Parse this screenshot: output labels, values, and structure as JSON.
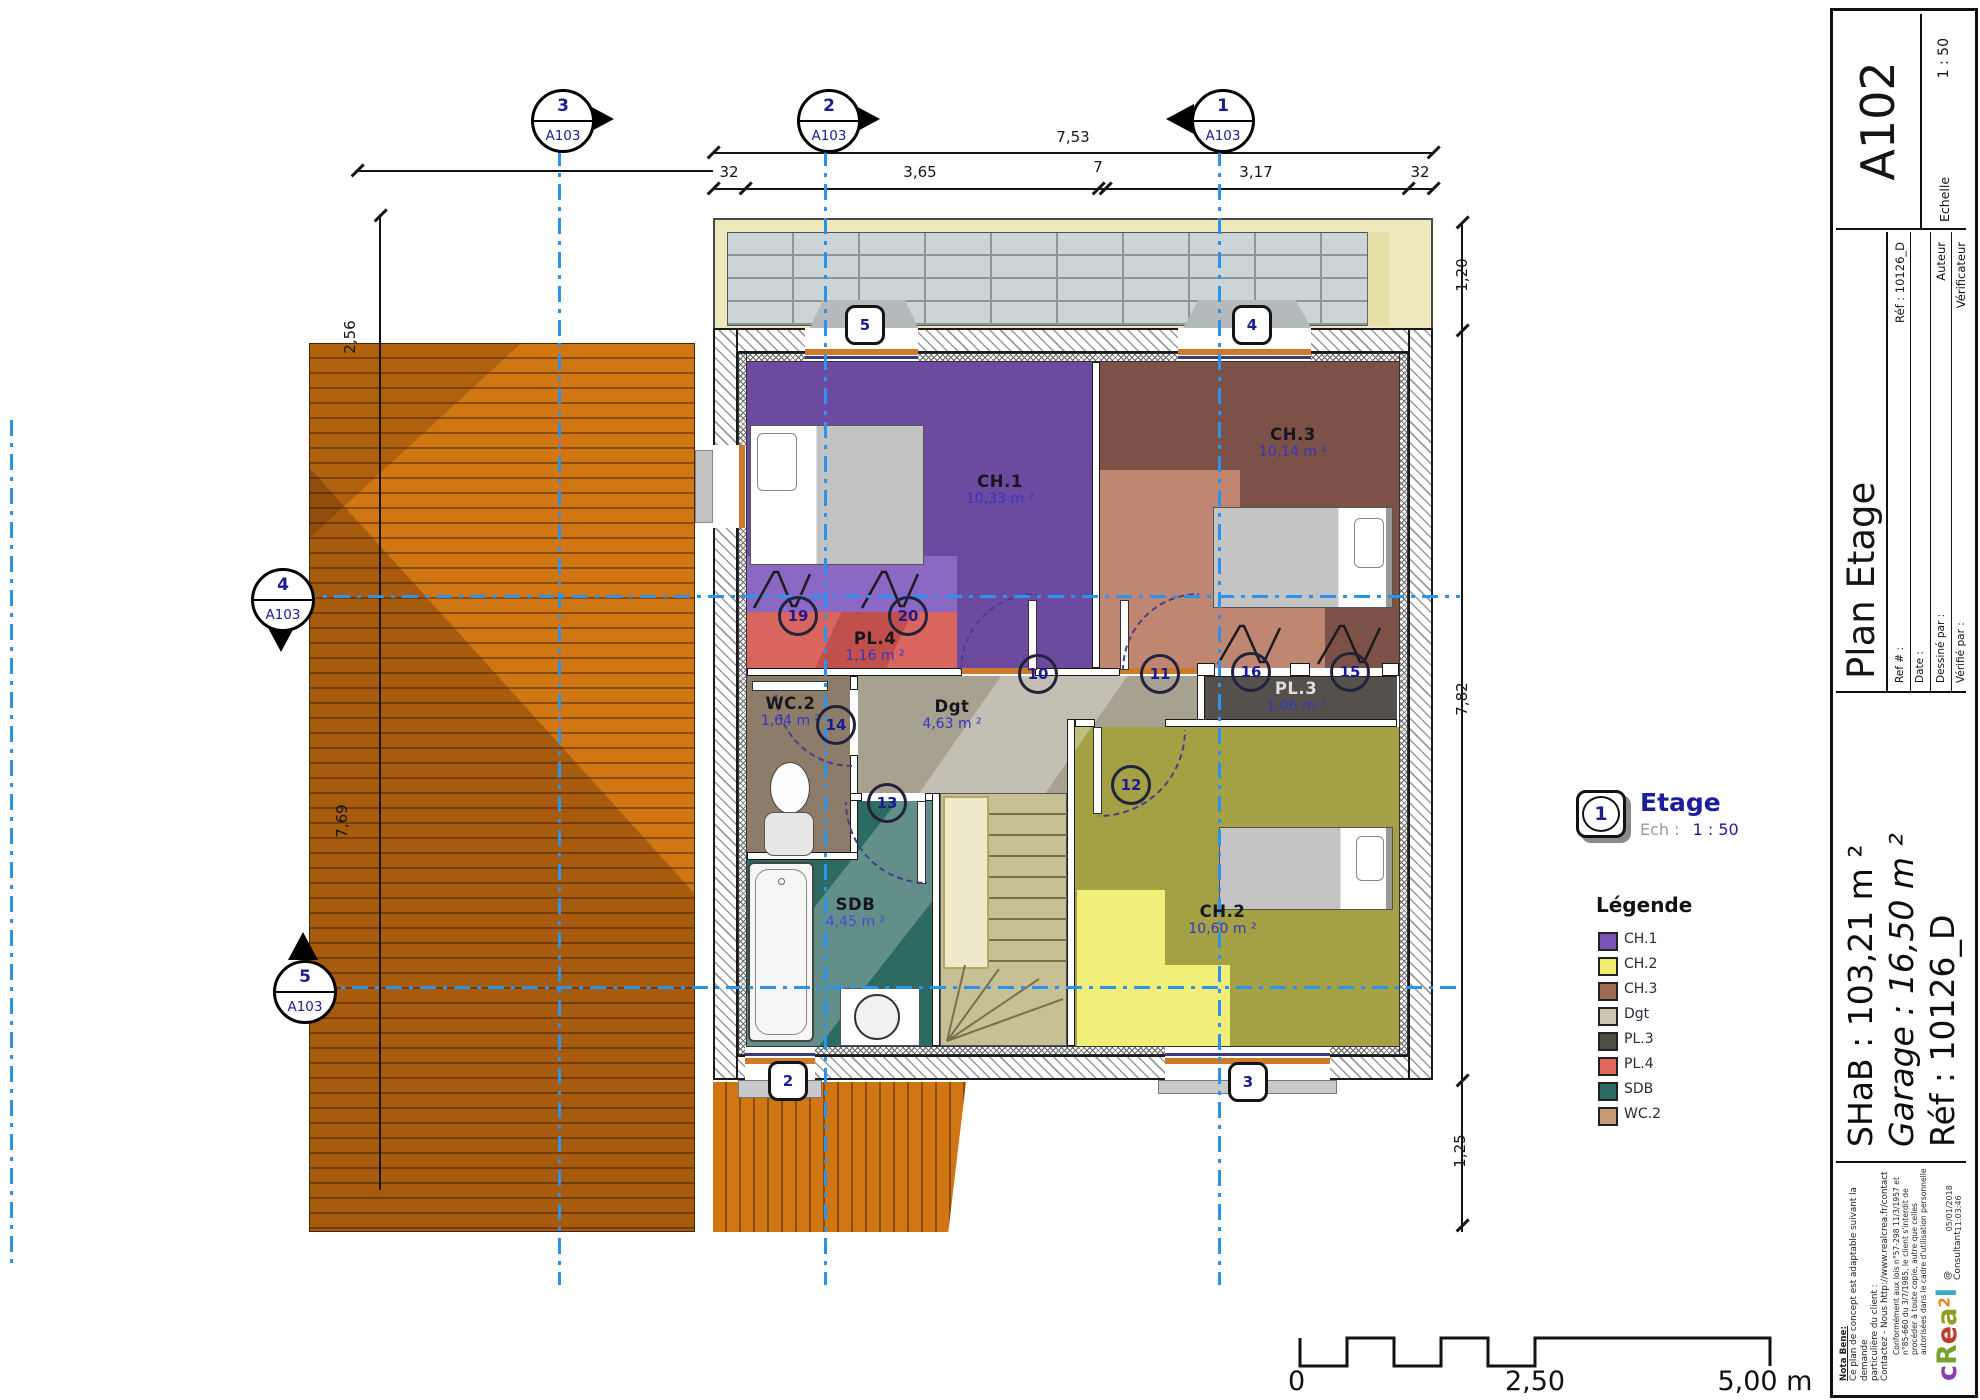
{
  "plan": {
    "rooms": [
      {
        "id": "ch1",
        "name": "CH.1",
        "area": "10,33 m ²"
      },
      {
        "id": "ch3",
        "name": "CH.3",
        "area": "10,14 m ²"
      },
      {
        "id": "pl4",
        "name": "PL.4",
        "area": "1,16 m ²"
      },
      {
        "id": "wc2",
        "name": "WC.2",
        "area": "1,64 m ²"
      },
      {
        "id": "dgt",
        "name": "Dgt",
        "area": "4,63 m ²"
      },
      {
        "id": "pl3",
        "name": "PL.3",
        "area": "1,06 m ²"
      },
      {
        "id": "sdb",
        "name": "SDB",
        "area": "4,45 m ²"
      },
      {
        "id": "ch2",
        "name": "CH.2",
        "area": "10,60 m ²"
      }
    ],
    "grid_markers": [
      {
        "num": "3",
        "sheet": "A103"
      },
      {
        "num": "2",
        "sheet": "A103"
      },
      {
        "num": "1",
        "sheet": "A103"
      },
      {
        "num": "4",
        "sheet": "A103"
      },
      {
        "num": "5",
        "sheet": "A103"
      }
    ],
    "window_tags": [
      "5",
      "4",
      "2",
      "3"
    ],
    "door_tags": [
      "19",
      "20",
      "10",
      "11",
      "14",
      "13",
      "12",
      "16",
      "15"
    ],
    "dimensions": {
      "overall_top": "7,53",
      "chain": [
        "32",
        "3,65",
        "7",
        "3,17",
        "32"
      ],
      "left_partial": "3,20",
      "left_upper": "2,56",
      "left_lower": "7,69",
      "right_top": "1,20",
      "right_mid": "7,82",
      "right_bottom": "1,25"
    },
    "scale_bar": {
      "start": "0",
      "mid": "2,50",
      "end": "5,00 m"
    },
    "view_label": {
      "num": "1",
      "title": "Etage",
      "scale_label": "Ech :",
      "scale_value": "1 : 50"
    }
  },
  "legend": {
    "title": "Légende",
    "items": [
      {
        "label": "CH.1",
        "color": "#7a52b8"
      },
      {
        "label": "CH.2",
        "color": "#f2ec6e"
      },
      {
        "label": "CH.3",
        "color": "#9d6a53"
      },
      {
        "label": "Dgt",
        "color": "#cdc7b0"
      },
      {
        "label": "PL.3",
        "color": "#4f4b46"
      },
      {
        "label": "PL.4",
        "color": "#e06660"
      },
      {
        "label": "SDB",
        "color": "#2d6a62"
      },
      {
        "label": "WC.2",
        "color": "#c59b78"
      }
    ]
  },
  "titleblock": {
    "title": "Plan Etage",
    "sheet_no": "A102",
    "fields": {
      "ref_label": "Ref # :",
      "ref_value": "Réf : 10126_D",
      "date_label": "Date :",
      "date_value": "",
      "drawn_label": "Dessiné par :",
      "drawn_value": "Auteur",
      "checked_label": "Vérifié par :",
      "checked_value": "Vérificateur",
      "scale_label": "Echelle",
      "scale_value": "1 : 50"
    },
    "summary": {
      "shab": "SHaB : 103,21 m ²",
      "garage": "Garage : 16,50 m ²",
      "ref": "Réf : 10126_D"
    },
    "notes": {
      "header": "Nota Bene:",
      "line1": "Ce plan de concept est adaptable suivant la demande",
      "line2": "particulière du client :",
      "line3": "Contactez - Nous http://www.realcrea.fr/contact",
      "legal": "Conformément aux lois n°57-298 11/3/1957 et n°85-660 du 3/7/1985, le client s'interdit de procéder à toute copie, autre que celles autorisées dans le cadre d'utilisation personnelle",
      "consultant": "@ Consultant",
      "timestamp": "05/01/2018 11:03:46"
    },
    "logo": {
      "letters": [
        {
          "ch": "c",
          "color": "#8a3fb0"
        },
        {
          "ch": "R",
          "color": "#76a32b"
        },
        {
          "ch": "e",
          "color": "#c23b2a"
        },
        {
          "ch": "a",
          "color": "#8f9e23"
        },
        {
          "ch": "2",
          "color": "#e2821c"
        },
        {
          "ch": "l",
          "color": "#3aa7c8"
        }
      ]
    }
  }
}
